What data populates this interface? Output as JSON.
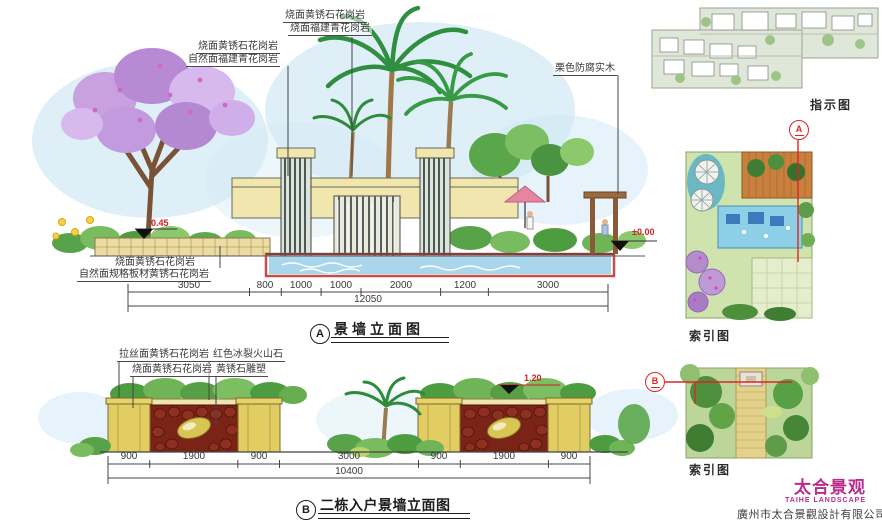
{
  "colors": {
    "accent_red": "#e02424",
    "brand_magenta": "#bb2b8d",
    "wall_cream": "#f0e6ae",
    "water_blue": "#a9d6ec",
    "lava_red": "#7a2317"
  },
  "drawing_a": {
    "ref": "A",
    "title": "景墙立面图",
    "annotations": {
      "top1_line1": "烧面黄锈石花岗岩",
      "top1_line2": "烧面福建青花岗岩",
      "top2_line1": "烧面黄锈石花岗岩",
      "top2_line2": "自然面福建青花岗岩",
      "right": "栗色防腐实木",
      "bottom_line1": "烧面黄锈石花岗岩",
      "bottom_line2": "自然面规格板材黄锈石花岗岩"
    },
    "elevation_left": "0.45",
    "elevation_right": "±0.00",
    "dims": [
      "3050",
      "800",
      "1000",
      "1000",
      "2000",
      "1200",
      "3000"
    ],
    "dim_total": "12050"
  },
  "drawing_b": {
    "ref": "B",
    "title": "二栋入户景墙立面图",
    "annotations": {
      "a1": "拉丝面黄锈石花岗岩",
      "a2": "烧面黄锈石花岗岩",
      "a3": "红色冰裂火山石",
      "a4": "黄锈石雕塑"
    },
    "elevation": "1.20",
    "dims": [
      "900",
      "1900",
      "900",
      "3000",
      "900",
      "1900",
      "900"
    ],
    "dim_total": "10400"
  },
  "side": {
    "plan_label": "指示图",
    "index1_label": "索引图",
    "index2_label": "索引图",
    "marker_a": "A",
    "marker_b": "B"
  },
  "footer": {
    "logo_cn": "太合景观",
    "logo_en": "TAIHE LANDSCAPE",
    "company": "廣州市太合景觀設計有限公司"
  }
}
